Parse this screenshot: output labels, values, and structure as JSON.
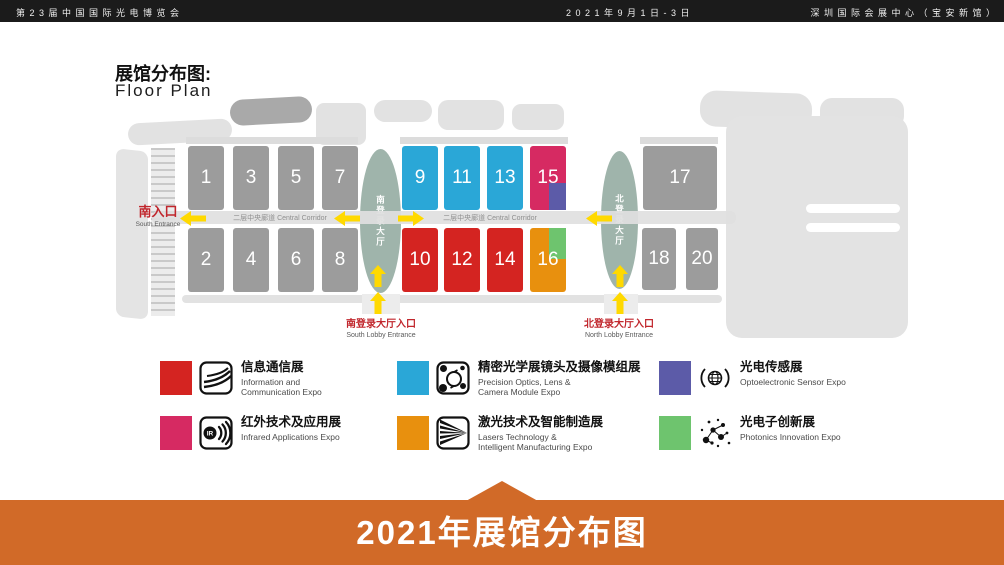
{
  "header": {
    "expo_title": "第 2 3 届 中 国 国 际 光 电 博 览 会",
    "dates": "2 0 2 1 年 9 月 1 日 - 3 日",
    "venue": "深 圳 国 际 会 展 中 心 （ 宝 安 新 馆 ）"
  },
  "plan": {
    "title_zh": "展馆分布图:",
    "title_en": "Floor Plan",
    "corridor_label": "二层中央廊道  Central Corridor",
    "south_entrance_zh": "南入口",
    "south_entrance_en": "South Entrance",
    "south_lobby_zh": "南登录大厅入口",
    "south_lobby_en": "South Lobby Entrance",
    "north_lobby_zh": "北登录大厅入口",
    "north_lobby_en": "North Lobby Entrance",
    "south_hall_label": "南登录大厅",
    "north_hall_label": "北登录大厅",
    "halls": [
      {
        "num": "1",
        "x": 188,
        "y": 146,
        "w": 36,
        "h": 64,
        "color": "#9c9c9c"
      },
      {
        "num": "3",
        "x": 233,
        "y": 146,
        "w": 36,
        "h": 64,
        "color": "#9c9c9c"
      },
      {
        "num": "5",
        "x": 278,
        "y": 146,
        "w": 36,
        "h": 64,
        "color": "#9c9c9c"
      },
      {
        "num": "7",
        "x": 322,
        "y": 146,
        "w": 36,
        "h": 64,
        "color": "#9c9c9c"
      },
      {
        "num": "2",
        "x": 188,
        "y": 228,
        "w": 36,
        "h": 64,
        "color": "#9c9c9c"
      },
      {
        "num": "4",
        "x": 233,
        "y": 228,
        "w": 36,
        "h": 64,
        "color": "#9c9c9c"
      },
      {
        "num": "6",
        "x": 278,
        "y": 228,
        "w": 36,
        "h": 64,
        "color": "#9c9c9c"
      },
      {
        "num": "8",
        "x": 322,
        "y": 228,
        "w": 36,
        "h": 64,
        "color": "#9c9c9c"
      },
      {
        "num": "9",
        "x": 402,
        "y": 146,
        "w": 36,
        "h": 64,
        "color": "#2aa7d7"
      },
      {
        "num": "11",
        "x": 444,
        "y": 146,
        "w": 36,
        "h": 64,
        "color": "#2aa7d7"
      },
      {
        "num": "13",
        "x": 487,
        "y": 146,
        "w": 36,
        "h": 64,
        "color": "#2aa7d7"
      },
      {
        "num": "15",
        "x": 530,
        "y": 146,
        "w": 36,
        "h": 64,
        "color": "#d62a62",
        "corner": {
          "color": "#5c5ba8",
          "pos": "br",
          "w": 0.46,
          "h": 0.42
        }
      },
      {
        "num": "10",
        "x": 402,
        "y": 228,
        "w": 36,
        "h": 64,
        "color": "#d42421"
      },
      {
        "num": "12",
        "x": 444,
        "y": 228,
        "w": 36,
        "h": 64,
        "color": "#d42421"
      },
      {
        "num": "14",
        "x": 487,
        "y": 228,
        "w": 36,
        "h": 64,
        "color": "#d42421"
      },
      {
        "num": "16",
        "x": 530,
        "y": 228,
        "w": 36,
        "h": 64,
        "color": "#e8900e",
        "corner": {
          "color": "#6ec46e",
          "pos": "tr",
          "w": 0.46,
          "h": 0.48
        }
      },
      {
        "num": "17",
        "x": 643,
        "y": 146,
        "w": 74,
        "h": 64,
        "color": "#9c9c9c"
      },
      {
        "num": "18",
        "x": 642,
        "y": 228,
        "w": 34,
        "h": 62,
        "color": "#9c9c9c"
      },
      {
        "num": "20",
        "x": 686,
        "y": 228,
        "w": 32,
        "h": 62,
        "color": "#9c9c9c"
      }
    ],
    "colors": {
      "hall_gray": "#9c9c9c",
      "cyan": "#2aa7d7",
      "red": "#d42421",
      "pink": "#d62a62",
      "purple": "#5c5ba8",
      "orange": "#e8900e",
      "green": "#6ec46e",
      "lobby_oval": "#9fb4ab",
      "arrow_yellow": "#ffd900",
      "entrance_red": "#c1272d"
    }
  },
  "legend": [
    {
      "icon": "fiber-optics-icon",
      "color": "#d42421",
      "zh": "信息通信展",
      "en": "Information and\nCommunication Expo"
    },
    {
      "icon": "camera-lens-icon",
      "color": "#2aa7d7",
      "zh": "精密光学展镜头及摄像模组展",
      "en": "Precision Optics, Lens &\nCamera Module Expo"
    },
    {
      "icon": "optoelectronic-sensor-icon",
      "color": "#5c5ba8",
      "zh": "光电传感展",
      "en": "Optoelectronic Sensor Expo"
    },
    {
      "icon": "infrared-icon",
      "color": "#d62a62",
      "zh": "红外技术及应用展",
      "en": "Infrared Applications Expo"
    },
    {
      "icon": "laser-beam-icon",
      "color": "#e8900e",
      "zh": "激光技术及智能制造展",
      "en": "Lasers Technology &\nIntelligent Manufacturing Expo"
    },
    {
      "icon": "photonics-network-icon",
      "color": "#6ec46e",
      "zh": "光电子创新展",
      "en": "Photonics Innovation Expo"
    }
  ],
  "footer": {
    "label": "2021年展馆分布图",
    "bg": "#d16a28"
  }
}
